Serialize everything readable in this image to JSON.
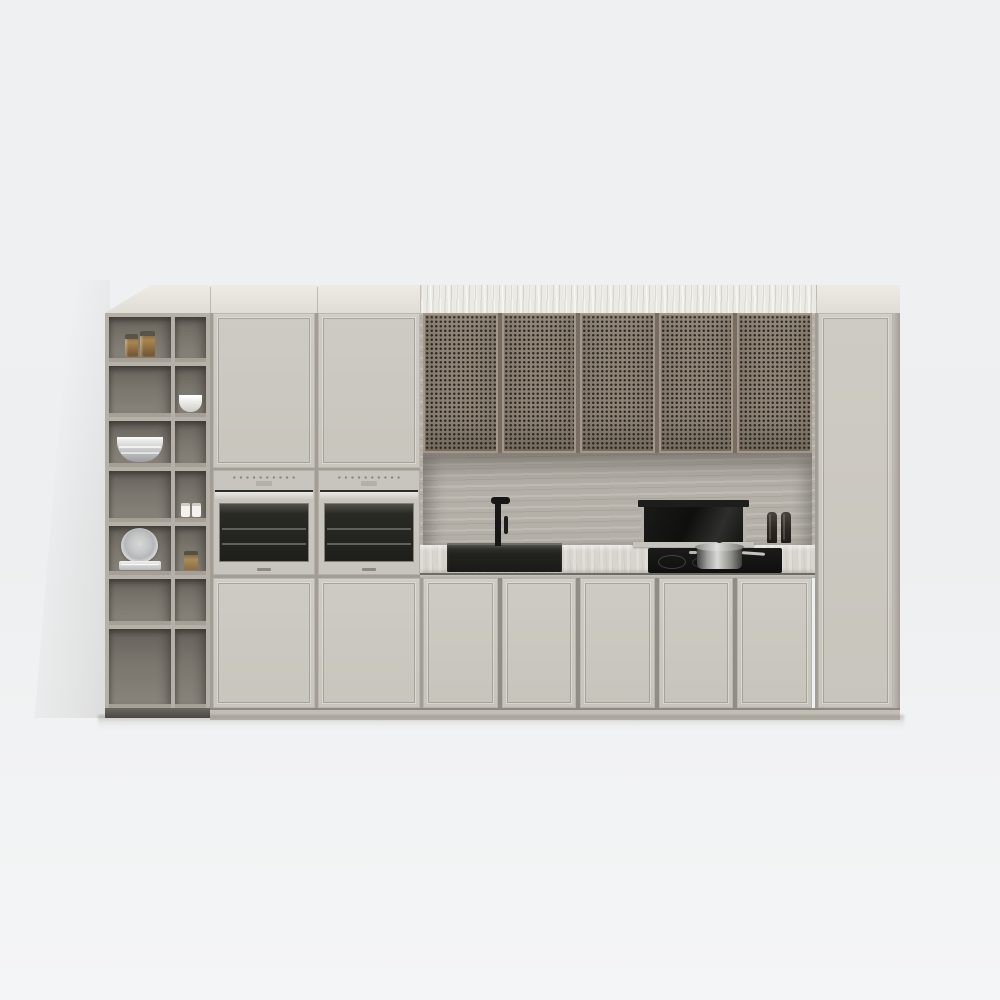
{
  "scene": {
    "type": "3d-render",
    "subject": "Modern minimalist kitchen cabinetry wall unit, front elevation",
    "background": {
      "wall_color": "#eff0f2",
      "floor_color": "#f4f5f6",
      "wall_shadow": "soft diagonal shadow left of unit"
    },
    "unit": {
      "finish_color": "#c9c5bd",
      "crown_color": "#e7e5de",
      "crown_marble_color": "#ebeae4",
      "sections": [
        "open-shelving",
        "tall-oven-column",
        "cooking-niche",
        "right-tall-cabinet"
      ]
    },
    "shelving": {
      "columns": 2,
      "rows": 7,
      "frame_color": "#b6b1a8",
      "interior_color": "#7b766d",
      "items": [
        {
          "name": "amber glass jar small",
          "cell": "row1-left"
        },
        {
          "name": "amber glass jar tall",
          "cell": "row1-left"
        },
        {
          "name": "white bowl",
          "cell": "row2-right"
        },
        {
          "name": "stacked metal bowls",
          "cell": "row3-left"
        },
        {
          "name": "small white jar",
          "cell": "row4-right"
        },
        {
          "name": "small white jar",
          "cell": "row4-right"
        },
        {
          "name": "upright plate with plate stack",
          "cell": "row5-left"
        },
        {
          "name": "amber spice jar",
          "cell": "row5-right"
        }
      ]
    },
    "upper_cabinets": {
      "doors": 5,
      "style": "cane mesh",
      "mesh_color": "#8d8274",
      "perforation_color": "#2d2922",
      "frame_color": "#a4978a"
    },
    "appliances": {
      "ovens": {
        "count": 2,
        "front_color": "#c8c5bf",
        "glass_color": "#1e1e1b",
        "controls": "button dot row with small display",
        "brand_badge": "small illegible mark"
      },
      "downdraft_hood": {
        "state": "raised",
        "glass_color": "#151514",
        "rail_color": "#b4b2ad"
      },
      "induction_cooktop": {
        "color": "#121211",
        "burner_rings": 2
      },
      "sink": {
        "color": "#1e1e1c",
        "style": "undermount rectangular"
      },
      "faucet": {
        "color": "#171717",
        "style": "matte black single-lever"
      }
    },
    "countertop": {
      "color": "#d7d5ce",
      "material": "light stone",
      "backsplash_material": "travertine",
      "backsplash_color": "#b4b0a8"
    },
    "lower_cabinets": {
      "doors_under_ovens": 2,
      "doors_under_counter": 5,
      "right_tall_doors": 1,
      "tall_doors_above_ovens": 2
    },
    "props": {
      "pot": "stainless steel pot with lid on cooktop",
      "pepper_mills": 2,
      "pepper_mill_color": "#2c2721"
    }
  }
}
